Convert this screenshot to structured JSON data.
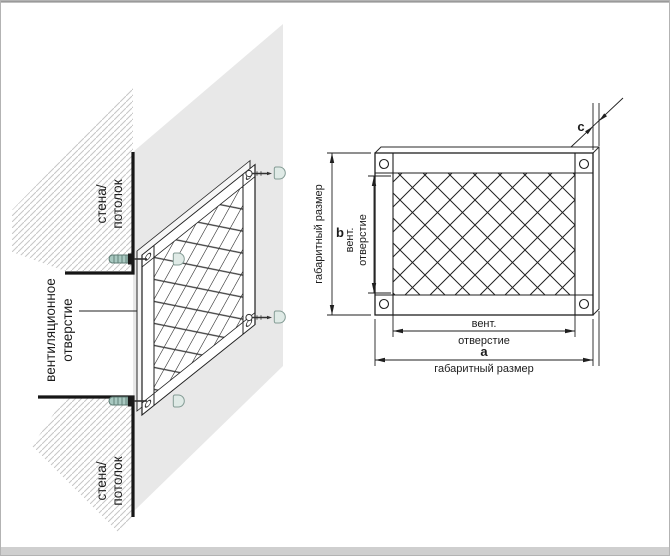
{
  "diagram": {
    "type": "ventilation-grille-installation-diagram",
    "left_view": {
      "wall_label_line1": "стена/",
      "wall_label_line2": "потолок",
      "vent_label_line1": "вентиляционное",
      "vent_label_line2": "отверстие"
    },
    "front_view": {
      "overall_v_label": "габаритный размер",
      "overall_v_letter": "b",
      "vent_v_line1": "вент.",
      "vent_v_line2": "отверстие",
      "vent_h_line1": "вент.",
      "vent_h_line2": "отверстие",
      "overall_h_letter": "a",
      "overall_h_label": "габаритный размер",
      "depth_letter": "c"
    },
    "colors": {
      "wall_fill": "#e8e8e8",
      "hatch_line": "#c6c6c6",
      "draw_line": "#1f1f1f",
      "dowel_fill": "#a9c9c1",
      "dowel_stroke": "#5d7c74",
      "cap_fill": "#dfeae6",
      "cap_stroke": "#849c95",
      "page_border": "#b3b3b3",
      "bottom_band": "#cfcfcf"
    }
  }
}
